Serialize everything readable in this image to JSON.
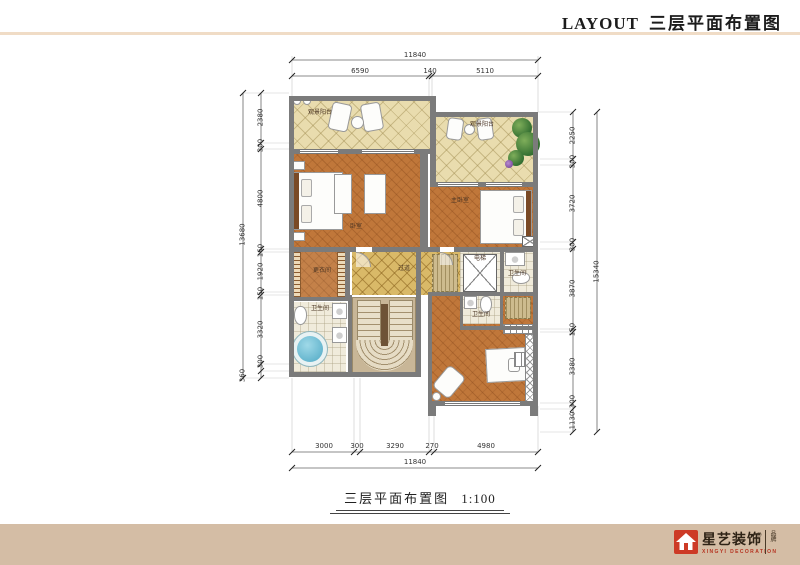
{
  "header": {
    "title_en": "LAYOUT",
    "title_zh": "三层平面布置图"
  },
  "caption": {
    "title": "三层平面布置图",
    "scale": "1:100"
  },
  "rooms": {
    "balcony_left": "观景阳台",
    "balcony_right": "观景阳台",
    "bedroom_left": "卧室",
    "bedroom_right": "主卧室",
    "dressing_room": "更衣间",
    "bathroom_left": "卫生间",
    "bathroom_upper_right": "卫生间",
    "bathroom_center": "卫生间",
    "corridor": "过道",
    "elevator": "电梯"
  },
  "dimensions": {
    "top": {
      "total": "11840",
      "segments": [
        "6590",
        "140",
        "5110"
      ]
    },
    "bottom": {
      "total": "11840",
      "segments": [
        "3000",
        "300",
        "3290",
        "270",
        "4980"
      ]
    },
    "left": {
      "total": "13680",
      "segments": [
        "2380",
        "300",
        "4800",
        "160",
        "1920",
        "150",
        "3320",
        "300",
        "360"
      ]
    },
    "right": {
      "total": "15340",
      "segments": [
        "2250",
        "300",
        "3720",
        "300",
        "3870",
        "150",
        "3380",
        "300",
        "1130"
      ]
    }
  },
  "footer": {
    "brand_zh": "星艺装饰",
    "trademark": "®",
    "brand_en": "XINGYI DECORATION",
    "vertical_text": "品牌"
  },
  "colors": {
    "accent_red": "#cd3a26",
    "footer_bar": "#d4bda5",
    "wall_gray": "#7b7b7b",
    "parquet": "#c0773a",
    "balcony_tile": "#e9dcae",
    "corridor_tile": "#d9b968",
    "tub_blue": "#62b8cf"
  }
}
